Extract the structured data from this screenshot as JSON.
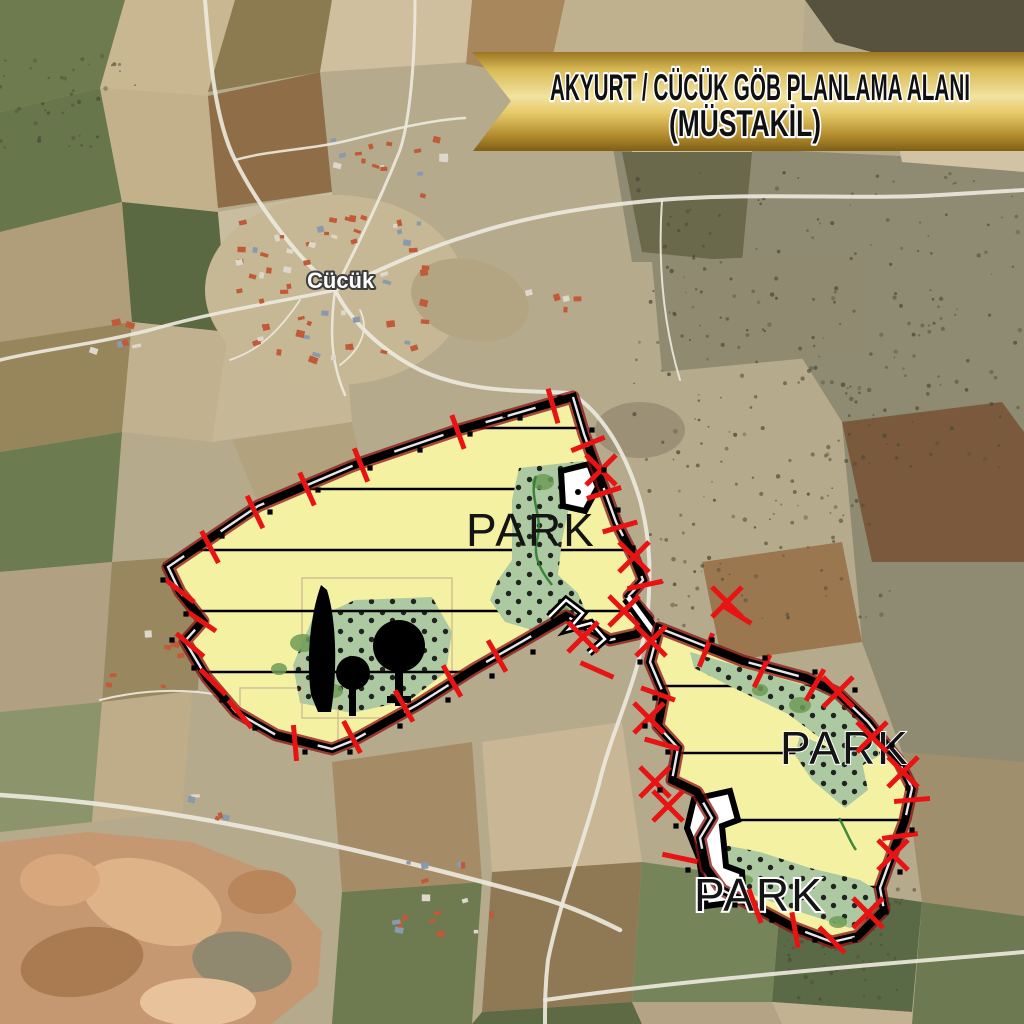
{
  "banner": {
    "line1": "AKYURT / CÜCÜK GÖB PLANLAMA ALANI",
    "line2": "(MÜSTAKİL)",
    "gold_light": "#f2e3a0",
    "gold_mid": "#d8b955",
    "gold_dark": "#7e5f18",
    "text_color": "#101010",
    "outline_color": "#ffffff"
  },
  "map": {
    "village_label": "Cücük",
    "label_color": "#ffffff",
    "label_outline": "#3c3c3c"
  },
  "overlay": {
    "park_labels": [
      "PARK",
      "PARK",
      "PARK"
    ],
    "zone_yellow": "#f5f1a2",
    "zone_green": "#adc9a2",
    "green_dark": "#6f9b57",
    "boundary_black": "#000000",
    "boundary_outer_red": "#8a1212",
    "boundary_inner_white": "#ffffff",
    "mark_red": "#e81414",
    "label_color": "#141414"
  }
}
